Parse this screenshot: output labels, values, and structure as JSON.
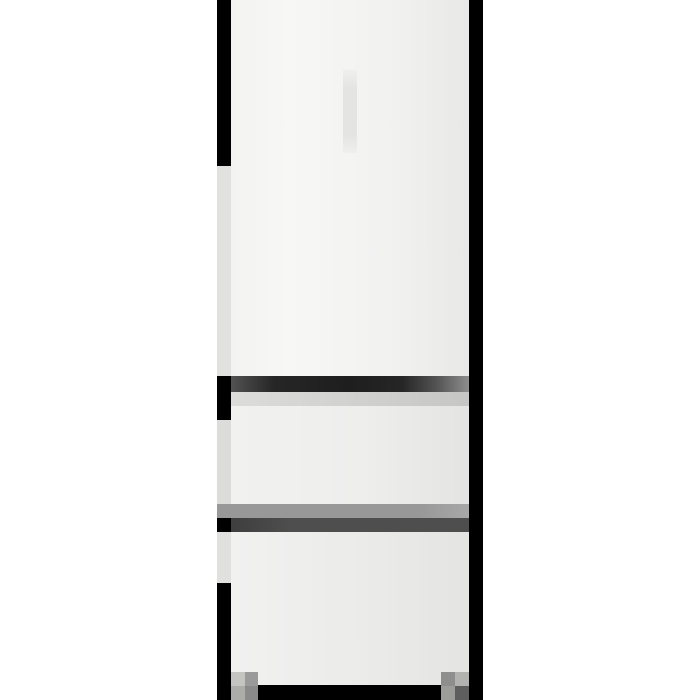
{
  "scene": {
    "subject": "White three-door refrigerator, front view: one tall fridge door above two freezer drawers, standing on two gray feet against a plain white background",
    "rendering": "low-resolution pixelated product photo",
    "parts": [
      "fridge door",
      "door handle recess",
      "door gap shadow",
      "upper freezer drawer",
      "drawer gap highlight",
      "drawer gap shadow",
      "lower freezer drawer",
      "left edge shadow",
      "right edge shadow",
      "base plinth shadow",
      "left foot",
      "right foot"
    ]
  },
  "palette": {
    "bg": "#ffffff",
    "black": "#000000",
    "doorEdgeL": "#f3f3f2",
    "doorHi": "#f7f7f6",
    "doorMid": "#f1f1f0",
    "doorEdgeR": "#e8e8e7",
    "handle": "#e4e4e3",
    "handleSoft": "#efefee",
    "gapEdgeL": "#525252",
    "gapDark": "#262626",
    "gapDark2": "#1e1e1e",
    "gapEdgeR": "#8e8e8e",
    "gapLightL": "#dcdcdb",
    "gapLightR": "#c6c6c5",
    "drawerL": "#f1f1f0",
    "drawerM": "#eeeeed",
    "drawerR": "#e4e4e3",
    "drawer2M": "#ebebea",
    "bandGray": "#989898",
    "bandGrayR": "#a8a8a8",
    "bandDarkL": "#3e3e3e",
    "bandDark": "#4e4e4e",
    "sideA": "#e1e1df",
    "sideB": "#dcdcda",
    "sideC": "#e0e0de",
    "sideGray": "#a0a0a0",
    "footLA": "#c4c4c3",
    "footLB": "#9a9a9a",
    "footLC": "#acacab",
    "footLD": "#8a8a8a",
    "footRA": "#8e8e8e",
    "footRB": "#b2b2b1",
    "footRC": "#9c9c9b",
    "footRD": "#5e5e5e"
  }
}
